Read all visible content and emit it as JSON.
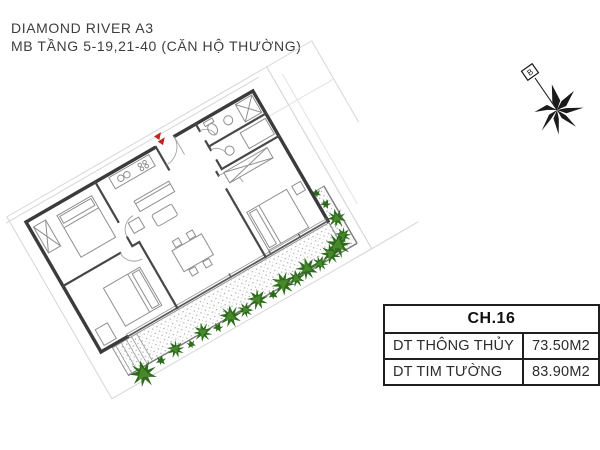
{
  "header": {
    "line1": "DIAMOND RIVER A3",
    "line2": "MB TẦNG 5-19,21-40 (CĂN HỘ THƯỜNG)"
  },
  "compass": {
    "north_label": "B"
  },
  "floorplan": {
    "entrance_marker_color": "#c0241e",
    "wall_color": "#3b3b3b",
    "vegetation_color": "#2e6b1c"
  },
  "info_table": {
    "header": "CH.16",
    "rows": [
      {
        "label": "DT THÔNG THỦY",
        "value": "73.50M2"
      },
      {
        "label": "DT TIM TƯỜNG",
        "value": "83.90M2"
      }
    ]
  }
}
